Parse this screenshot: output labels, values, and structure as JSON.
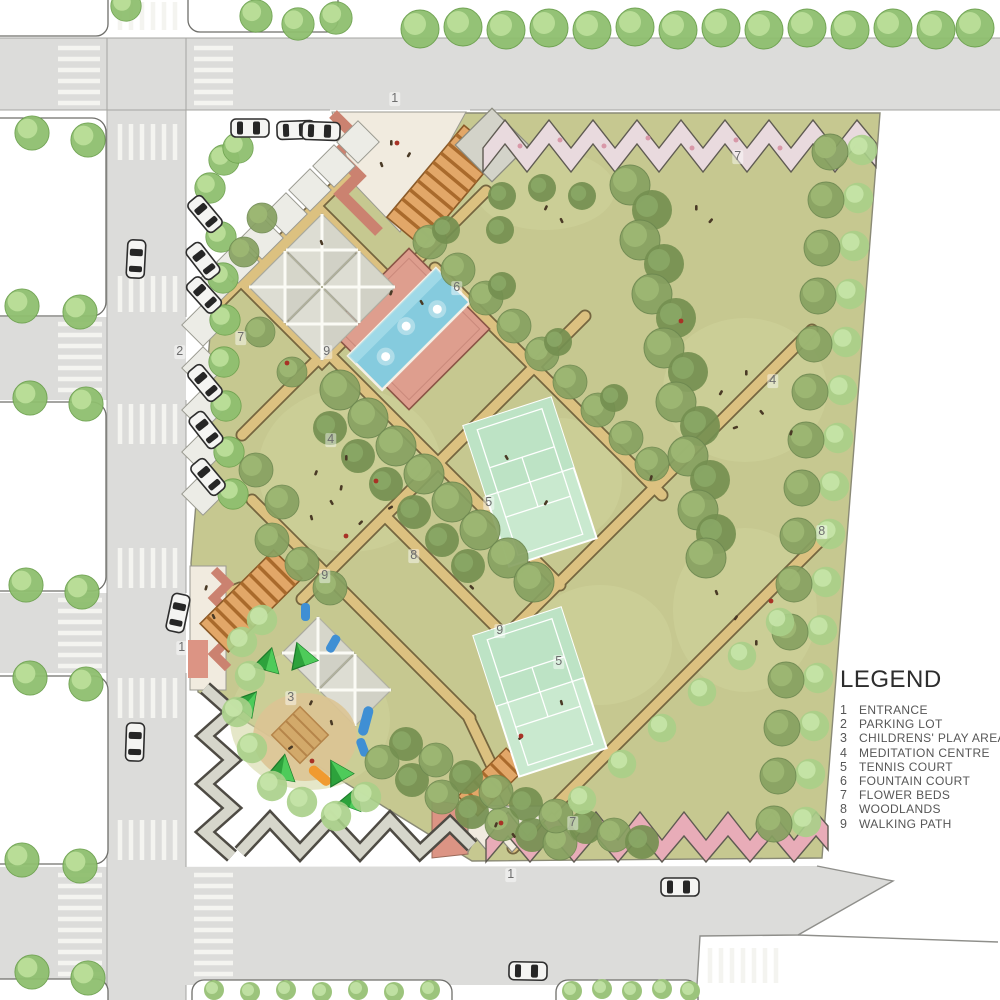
{
  "legend": {
    "title": "LEGEND",
    "items": [
      {
        "num": "1",
        "label": "ENTRANCE"
      },
      {
        "num": "2",
        "label": "PARKING LOT"
      },
      {
        "num": "3",
        "label": "CHILDRENS' PLAY AREA"
      },
      {
        "num": "4",
        "label": "MEDITATION CENTRE"
      },
      {
        "num": "5",
        "label": "TENNIS COURT"
      },
      {
        "num": "6",
        "label": "FOUNTAIN COURT"
      },
      {
        "num": "7",
        "label": "FLOWER BEDS"
      },
      {
        "num": "8",
        "label": "WOODLANDS"
      },
      {
        "num": "9",
        "label": "WALKING PATH"
      }
    ]
  },
  "markers": [
    {
      "text": "1"
    },
    {
      "text": "2"
    },
    {
      "text": "7"
    },
    {
      "text": "9"
    },
    {
      "text": "6"
    },
    {
      "text": "4"
    },
    {
      "text": "4"
    },
    {
      "text": "7"
    },
    {
      "text": "8"
    },
    {
      "text": "8"
    },
    {
      "text": "5"
    },
    {
      "text": "9"
    },
    {
      "text": "5"
    },
    {
      "text": "9"
    },
    {
      "text": "3"
    },
    {
      "text": "1"
    },
    {
      "text": "7"
    },
    {
      "text": "1"
    }
  ],
  "palette": {
    "road": "#dcdcda",
    "grass": "#c6c890",
    "path_tan": "#dcc180",
    "water": "#85cbde",
    "brick": "#de9e8e",
    "tennis_court": "#c9e9cf",
    "flower_pink": "#e8acb8",
    "flower_white": "#e9dade",
    "stone_wall": "#d6d6cb",
    "canopy": "#dddDd3",
    "play_green": "#35b148",
    "play_blue": "#3f8fd4",
    "play_orange": "#f09a30"
  }
}
